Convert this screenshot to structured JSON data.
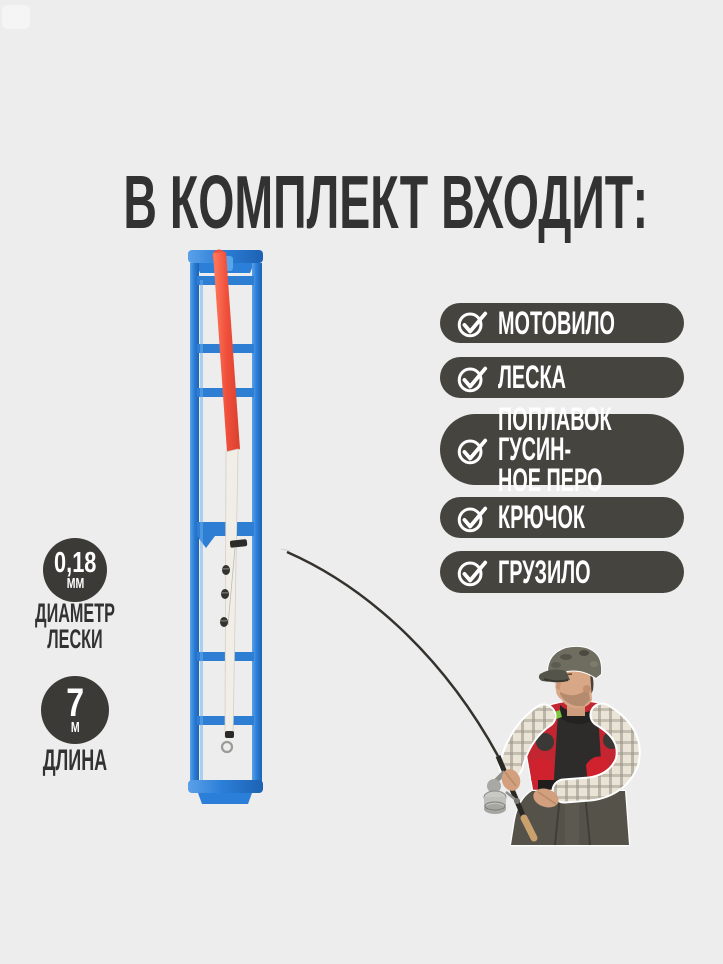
{
  "title": {
    "text": "В КОМПЛЕКТ ВХОДИТ:"
  },
  "included": {
    "items": [
      {
        "label": "МОТОВИЛО",
        "icon": "check-circle-icon"
      },
      {
        "label": "ЛЕСКА",
        "icon": "check-circle-icon"
      },
      {
        "label": "ПОПЛАВОК ГУСИН-\nНОЕ ПЕРО",
        "icon": "check-circle-icon"
      },
      {
        "label": "КРЮЧОК",
        "icon": "check-circle-icon"
      },
      {
        "label": "ГРУЗИЛО",
        "icon": "check-circle-icon"
      }
    ]
  },
  "specs": [
    {
      "value": "0,18",
      "unit": "ММ",
      "caption": "ДИАМЕТР\nЛЕСКИ"
    },
    {
      "value": "7",
      "unit": "М",
      "caption": "ДЛИНА"
    }
  ],
  "illustrations": {
    "line_winder": "blue plastic line winder with goose-feather float, split-shot sinkers and line",
    "fisherman": "fisherman in camo cap, plaid shirt and red vest holding bent rod with spinning reel"
  },
  "colors": {
    "background": "#ededed",
    "title_text": "#323232",
    "pill_background": "#46443f",
    "pill_text": "#ffffff",
    "badge_background": "#3b3a36",
    "winder_blue": "#2b7fd8",
    "float_orange": "#f0503c",
    "float_white": "#f1eee8",
    "vest_red": "#c32630",
    "vest_stripe_green": "#7cc53e"
  }
}
